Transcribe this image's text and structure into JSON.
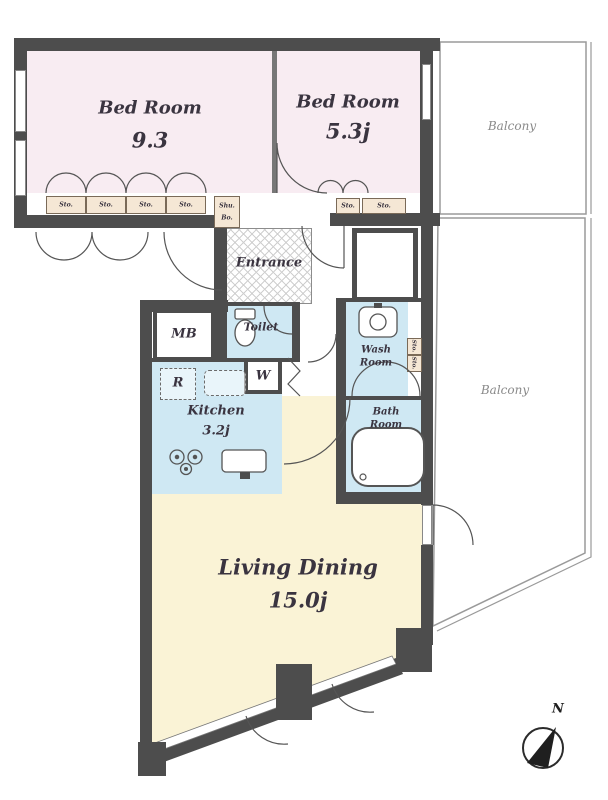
{
  "rooms": {
    "bedroom1": {
      "name": "Bed Room",
      "area": "9.3"
    },
    "bedroom2": {
      "name": "Bed Room",
      "area": "5.3j"
    },
    "living_dining": {
      "name": "Living Dining",
      "area": "15.0j"
    },
    "kitchen": {
      "name": "Kitchen",
      "area": "3.2j"
    },
    "entrance": {
      "name": "Entrance"
    },
    "toilet": {
      "name": "Toilet"
    },
    "wash_room": {
      "line1": "Wash",
      "line2": "Room"
    },
    "bath_room": {
      "line1": "Bath",
      "line2": "Room"
    },
    "balcony_top": {
      "name": "Balcony"
    },
    "balcony_side": {
      "name": "Balcony"
    }
  },
  "fixtures": {
    "meter_box": "MB",
    "washer": "W",
    "refrigerator": "R",
    "shoe_box_line1": "Shu.",
    "shoe_box_line2": "Bo."
  },
  "storage": {
    "bedroom1_cells": [
      "Sto.",
      "Sto.",
      "Sto.",
      "Sto."
    ],
    "bedroom2_cells": [
      "Sto.",
      "Sto."
    ],
    "washroom_cells": [
      "Sto.",
      "Sto."
    ]
  },
  "compass": {
    "north": "N"
  },
  "colors": {
    "wall": "#4d4d4d",
    "bedroom_fill": "#f8ecf2",
    "wet_area_fill": "#cfe8f3",
    "living_fill": "#faf3d6",
    "storage_fill": "#f5e7d5",
    "balcony_line": "#9a9a9a",
    "label_text": "#3a3440"
  }
}
